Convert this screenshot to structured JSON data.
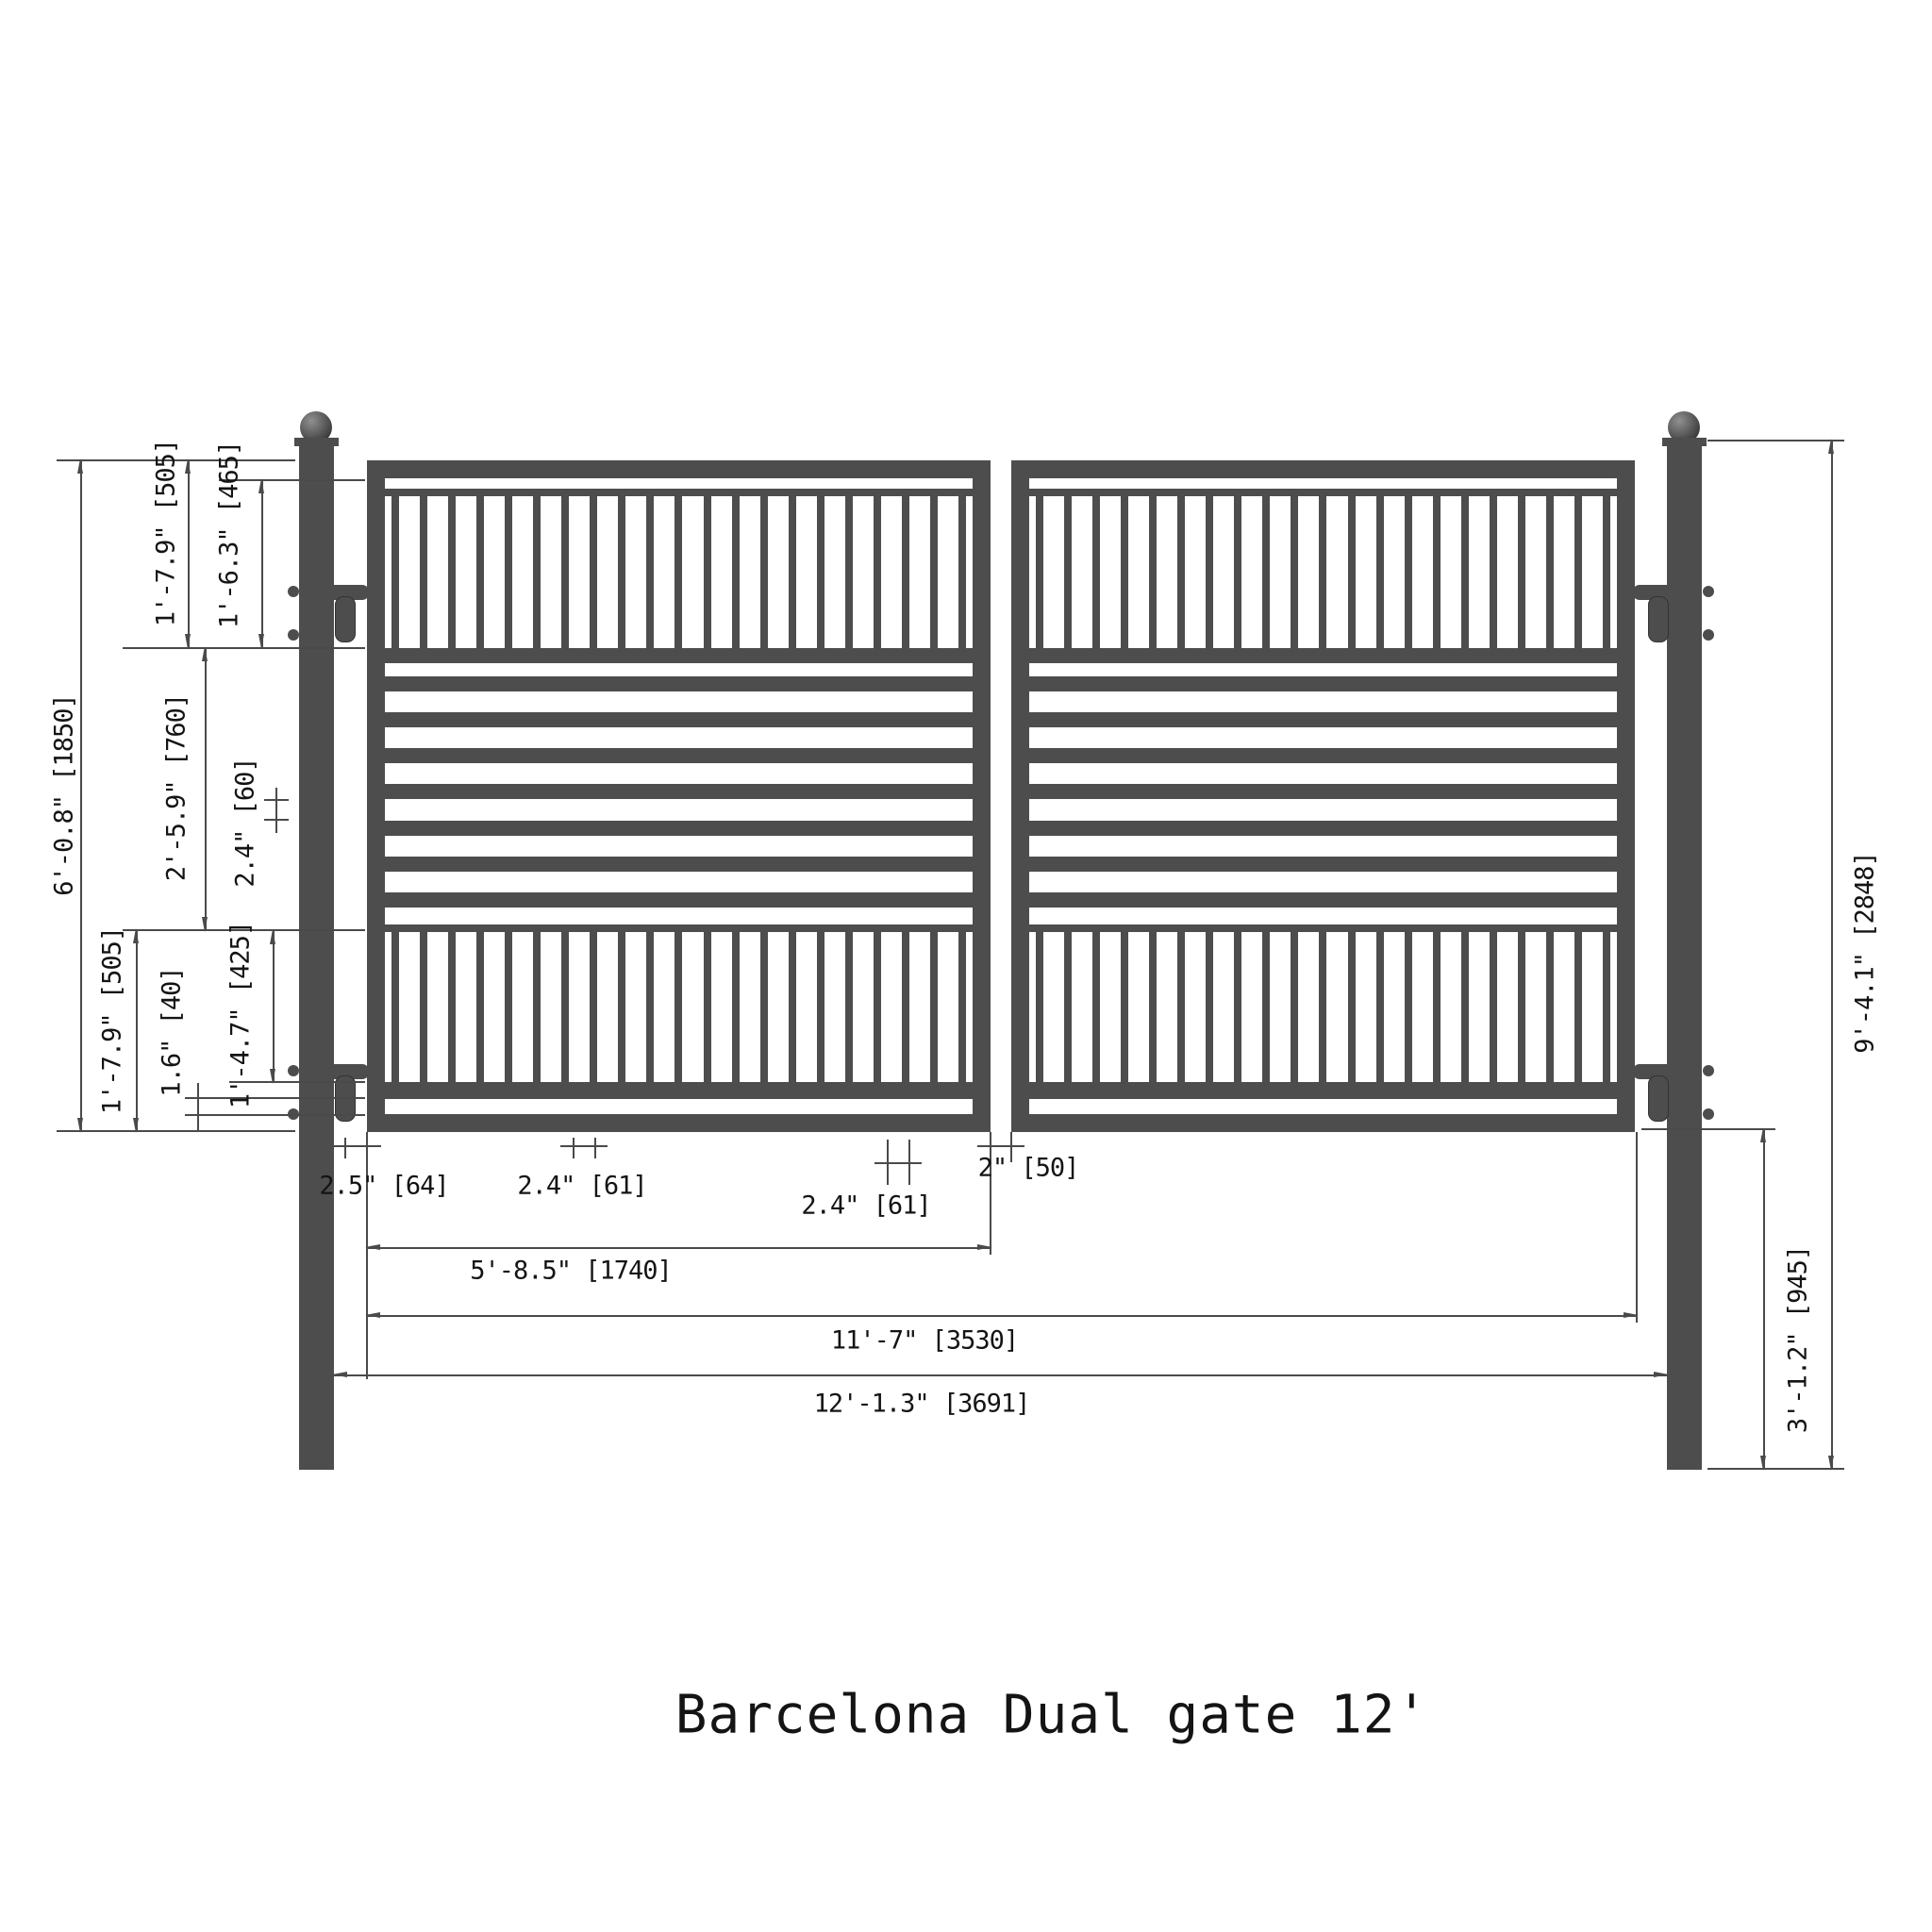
{
  "title": "Barcelona Dual gate 12'",
  "colors": {
    "steel": "#4d4d4d",
    "line": "#4a4a4a",
    "text": "#141414",
    "background": "#ffffff"
  },
  "gate": {
    "leaf_count": 2,
    "top_picket_count": 21,
    "bottom_picket_count": 21,
    "mid_bar_count": 7
  },
  "dims": {
    "left": [
      {
        "name": "gate-height",
        "label": "6'-0.8\" [1850]"
      },
      {
        "name": "top-section-height",
        "label": "1'-7.9\" [505]"
      },
      {
        "name": "top-picket-height",
        "label": "1'-6.3\" [465]"
      },
      {
        "name": "middle-section-height",
        "label": "2'-5.9\" [760]"
      },
      {
        "name": "bar-spacing",
        "label": "2.4\" [60]"
      },
      {
        "name": "bottom-section-height",
        "label": "1'-7.9\" [505]"
      },
      {
        "name": "bottom-gap",
        "label": "1.6\" [40]"
      },
      {
        "name": "bottom-picket-height",
        "label": "1'-4.7\" [425]"
      }
    ],
    "bottom": [
      {
        "name": "edge-picket-offset",
        "label": "2.5\" [64]"
      },
      {
        "name": "picket-gap-top",
        "label": "2.4\" [61]"
      },
      {
        "name": "picket-gap-bottom",
        "label": "2.4\" [61]"
      },
      {
        "name": "leaf-gap",
        "label": "2\" [50]"
      },
      {
        "name": "leaf-width",
        "label": "5'-8.5\" [1740]"
      },
      {
        "name": "gate-width",
        "label": "11'-7\" [3530]"
      },
      {
        "name": "overall-width",
        "label": "12'-1.3\" [3691]"
      }
    ],
    "right": [
      {
        "name": "post-below-gate",
        "label": "3'-1.2\" [945]"
      },
      {
        "name": "post-height",
        "label": "9'-4.1\" [2848]"
      }
    ]
  }
}
